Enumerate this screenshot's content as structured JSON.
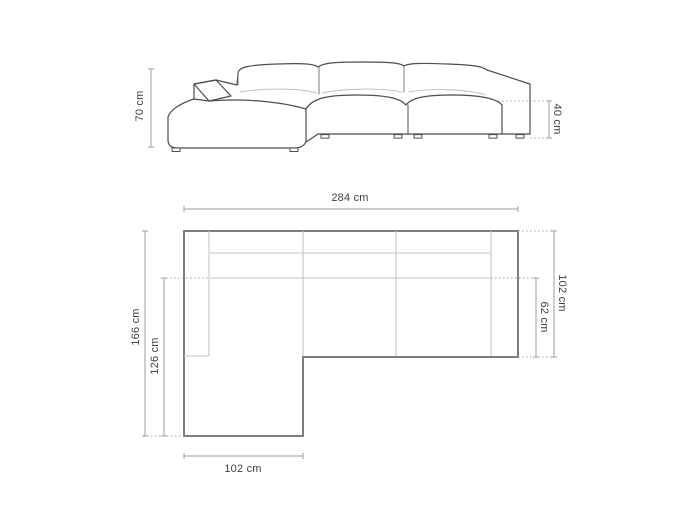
{
  "diagram": {
    "kind": "sofa-dimension-diagram",
    "views": {
      "front": {
        "dimensions": {
          "height": "70 cm",
          "seat_height": "40 cm"
        }
      },
      "top": {
        "dimensions": {
          "total_width": "284 cm",
          "total_depth": "102 cm",
          "seat_depth": "62 cm",
          "chaise_total_length": "166 cm",
          "chaise_seat_length": "126 cm",
          "chaise_width": "102 cm"
        }
      }
    },
    "colors": {
      "background": "#ffffff",
      "front_outline": "#4d4d4d",
      "plan_outline": "#7d7d7d",
      "inner_line": "#c6c6c6",
      "dimension_line": "#9e9e9e",
      "label_text": "#3f3f3f"
    }
  }
}
